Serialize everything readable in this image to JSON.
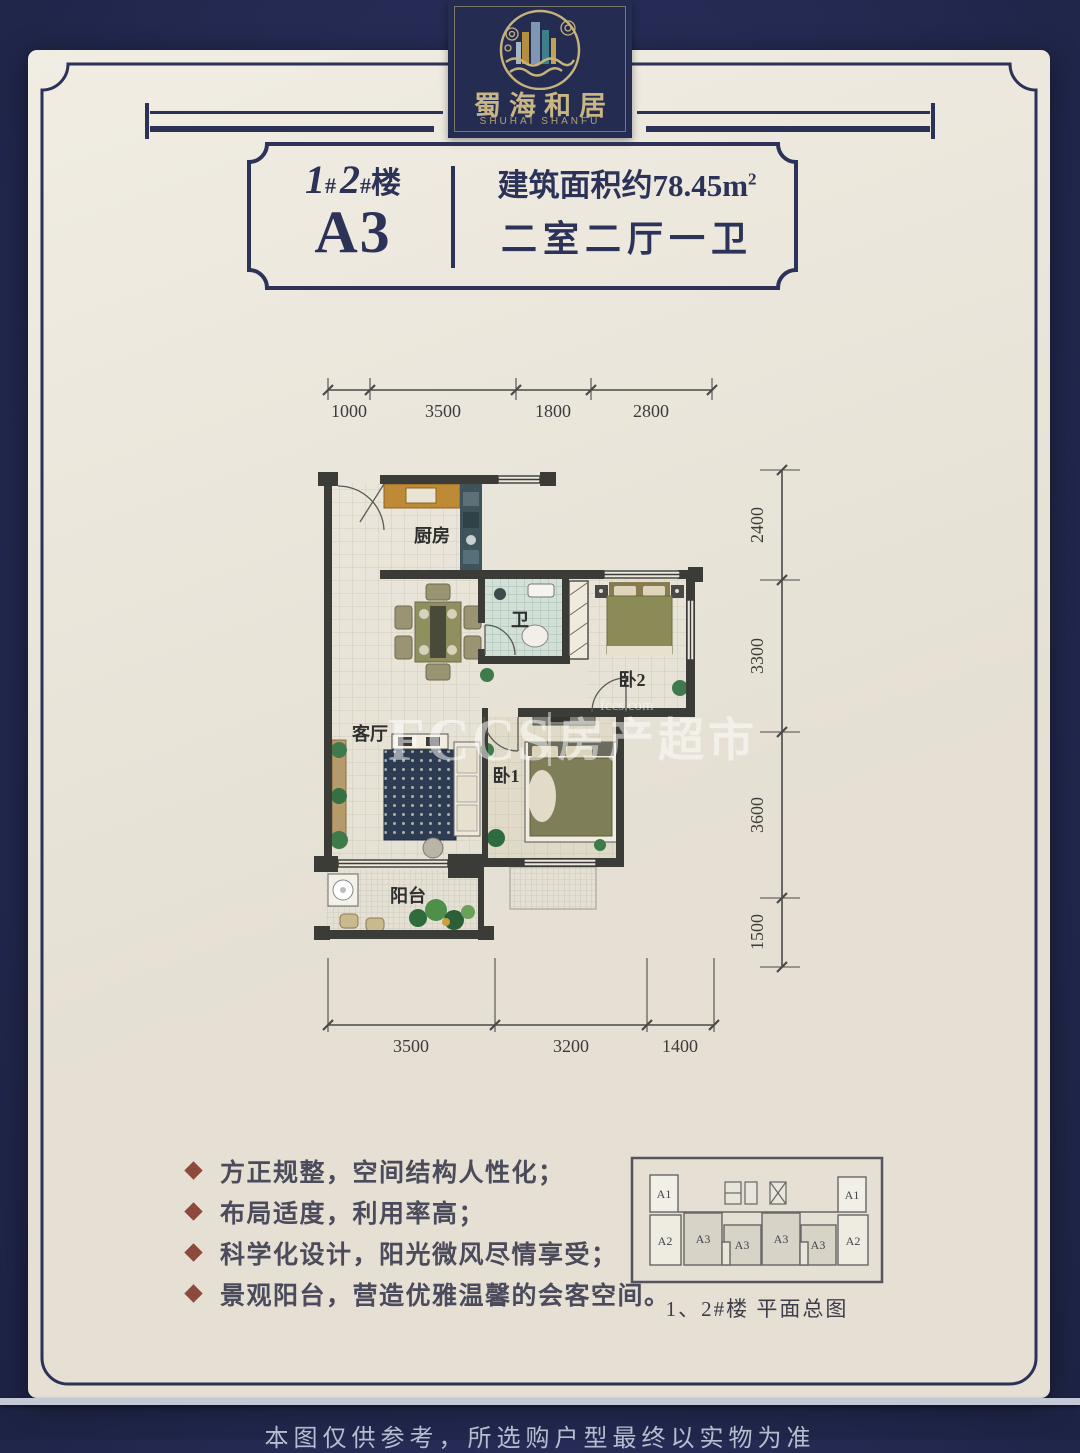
{
  "brand": {
    "logo_cn": "蜀海和居",
    "logo_en": "SHUHAI SHANFU"
  },
  "title_box": {
    "building_num1": "1",
    "building_hash1": "#",
    "building_num2": "2",
    "building_hash2": "#",
    "building_suffix": "楼",
    "unit": "A3",
    "area_prefix": "建筑面积约",
    "area_value": "78.45",
    "area_unit": "m",
    "area_sup": "2",
    "rooms_line": "二室二厅一卫"
  },
  "floor_plan": {
    "dims_top": [
      "1000",
      "3500",
      "1800",
      "2800"
    ],
    "dims_right": [
      "2400",
      "3300",
      "3600",
      "1500"
    ],
    "dims_bottom": [
      "3500",
      "3200",
      "1400"
    ],
    "rooms": {
      "kitchen": "厨房",
      "bathroom": "卫",
      "bedroom2": "卧2",
      "living_room": "客厅",
      "bedroom1": "卧1",
      "balcony": "阳台"
    },
    "watermark": {
      "brand": "FCCS",
      "brand_cn": "房产超市",
      "domain": "fccs.com"
    }
  },
  "features": [
    "方正规整，空间结构人性化；",
    "布局适度，利用率高；",
    "科学化设计，阳光微风尽情享受；",
    "景观阳台，营造优雅温馨的会客空间。"
  ],
  "key_plan": {
    "top_units": [
      "A1",
      "A1"
    ],
    "bottom_units": [
      "A2",
      "A3",
      "A3",
      "A3",
      "A3",
      "A2"
    ],
    "caption": "1、2#楼 平面总图"
  },
  "disclaimer": "本图仅供参考，所选购户型最终以实物为准",
  "colors": {
    "background_navy": "#232a4e",
    "poster_cream": "#ece7da",
    "border_navy": "#2d3358",
    "accent_gold": "#c9b685",
    "bullet_maroon": "#8d4a3c",
    "wall_dark": "#3b3b37",
    "counter_orange": "#bf8a35",
    "bed_olive": "#8b8b58",
    "rug_navy": "#2d3c52",
    "bath_tile": "#d3e0d8"
  }
}
